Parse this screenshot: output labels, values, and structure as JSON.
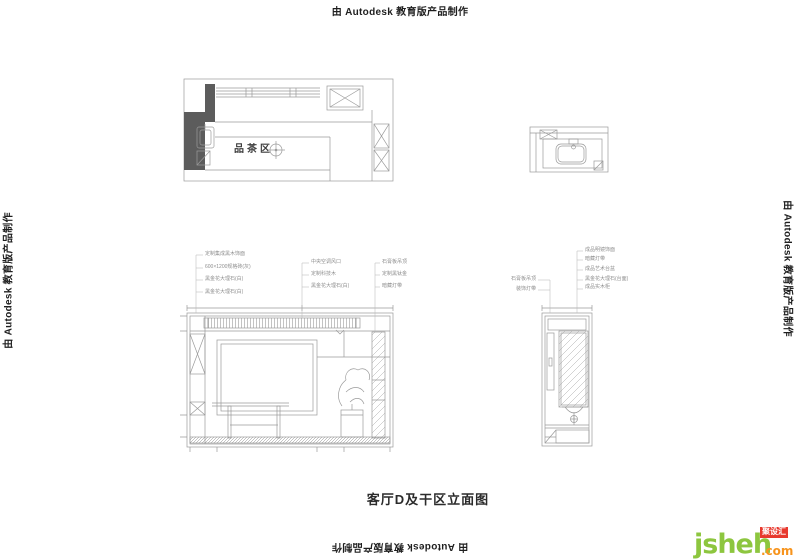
{
  "watermark": {
    "text": "由 Autodesk 教育版产品制作"
  },
  "title": {
    "text": "客厅D及干区立面图"
  },
  "plan": {
    "room_label": "品茶区"
  },
  "ann": {
    "main_left": [
      "定制集成黑木饰面",
      "600×1200规格砖(灰)",
      "黑金花大理石(白)",
      "黑金花大理石(白)"
    ],
    "main_mid": [
      "中央空调风口",
      "定制科技木",
      "黑金花大理石(白)"
    ],
    "main_right": [
      "石膏板吊顶",
      "定制黑钛金",
      "暗藏灯带"
    ],
    "vanity_left": [
      "石膏板吊顶",
      "装饰灯带"
    ],
    "vanity_right": [
      "成品明镜饰面",
      "暗藏灯带",
      "成品艺术台盆",
      "黑金花大理石(台面)",
      "成品实木柜"
    ]
  },
  "logo": {
    "name": "jsheh",
    "badge": "聚设汇",
    "tld": ".com"
  },
  "colors": {
    "logo_green": "#8dc63f",
    "logo_red": "#e8392e",
    "logo_orange": "#f7941d",
    "line": "#9a9a9a",
    "wall_fill": "#5c5c5c"
  }
}
